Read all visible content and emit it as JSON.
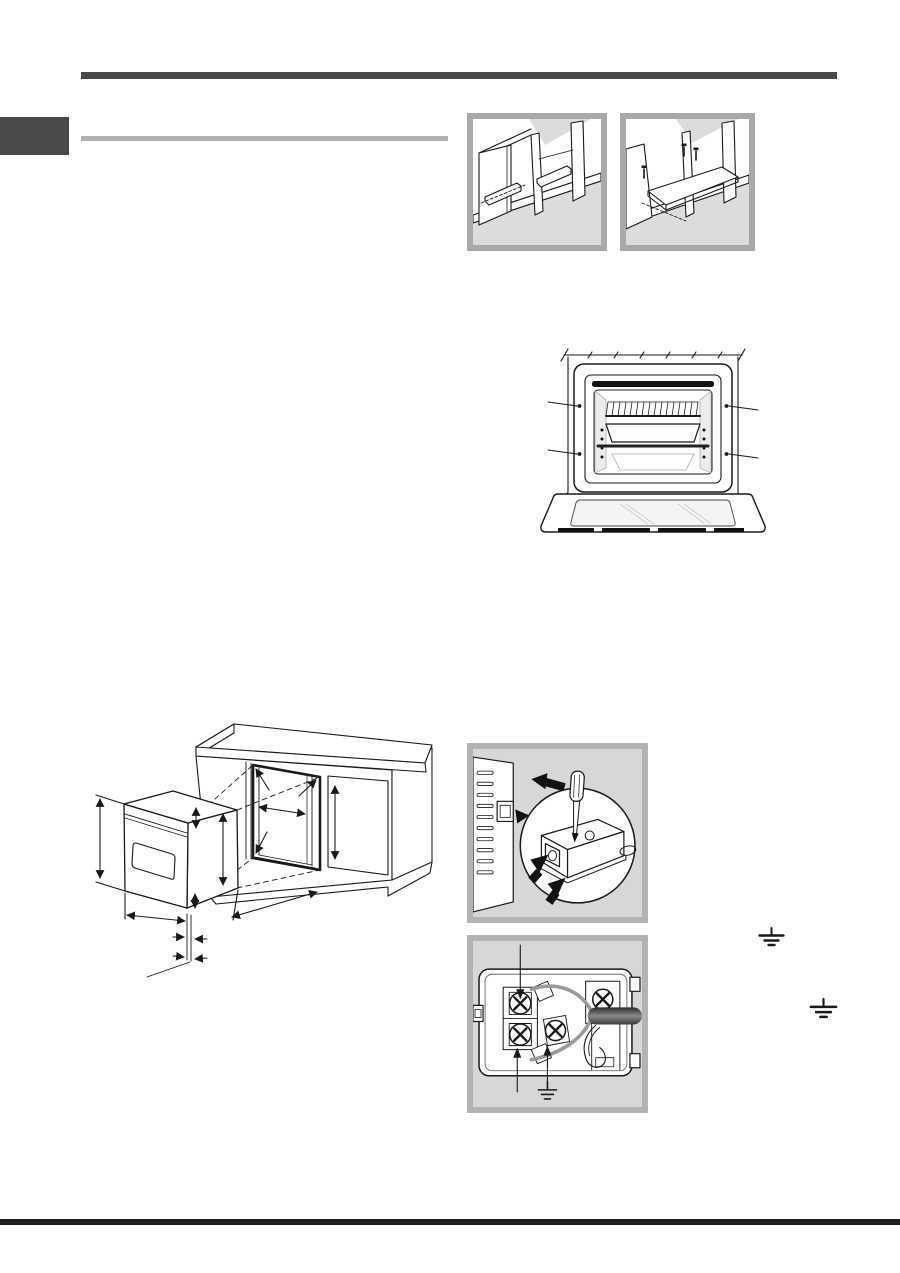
{
  "page": {
    "kind": "appliance-installation-manual-page",
    "visible_text": [],
    "page_width_px": 900,
    "page_height_px": 1273
  },
  "colors": {
    "page-bg": "#ffffff",
    "rule-dark": "#4a4a4a",
    "rule-light": "#b1b1b1",
    "footer-rule": "#1c1c1c",
    "tab": "#4a4a4a",
    "frame-border": "#a9a9a9",
    "frame-border-gray": "#b3b3b3",
    "frame-bg-gray": "#d7d7d7",
    "line-art": "#1a1a1a",
    "shade": "#dcdcdc"
  },
  "decorations": [
    {
      "name": "header-rule"
    },
    {
      "name": "page-edge-tab"
    },
    {
      "name": "section-title-rule"
    },
    {
      "name": "footer-rule"
    }
  ],
  "figures": [
    {
      "name": "figure-cabinet-support-battens"
    },
    {
      "name": "figure-cabinet-support-shelf"
    },
    {
      "name": "figure-oven-front-fixing-points"
    },
    {
      "name": "figure-built-in-dimensions"
    },
    {
      "name": "figure-terminal-cover-removal"
    },
    {
      "name": "figure-terminal-board-connection"
    }
  ],
  "symbols": [
    {
      "name": "earth-ground-symbol",
      "glyph": "⏚"
    },
    {
      "name": "earth-ground-symbol",
      "glyph": "⏚"
    },
    {
      "name": "earth-ground-symbol-in-figure",
      "glyph": "⏚"
    }
  ]
}
